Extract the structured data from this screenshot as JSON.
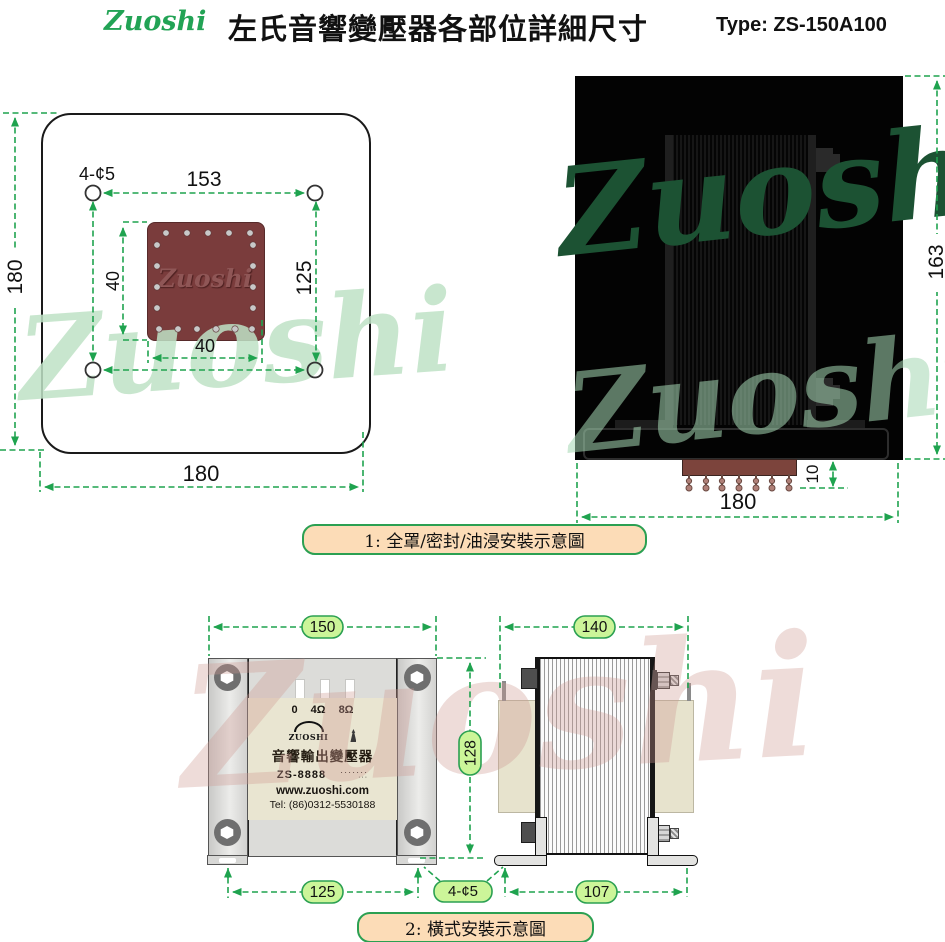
{
  "header": {
    "logo": "Zuoshi",
    "title": "左氏音響變壓器各部位詳細尺寸",
    "type_label": "Type: ZS-150A100"
  },
  "watermark": {
    "text": "Zuoshi"
  },
  "plate_view": {
    "hole_label": "4-¢5",
    "emboss": "Zuoshi",
    "dim_top_width": "153",
    "dim_left_height": "180",
    "dim_right_height": "125",
    "dim_square_height": "40",
    "dim_square_width": "40",
    "dim_bottom_width": "180"
  },
  "sealed_view": {
    "dim_height": "163",
    "dim_pin_height": "10",
    "dim_width": "180"
  },
  "caption1": "1: 全罩/密封/油浸安裝示意圖",
  "front_view": {
    "dim_width": "150",
    "dim_height": "128",
    "dim_hole_span": "125",
    "label": {
      "terminals": [
        "0",
        "4Ω",
        "8Ω"
      ],
      "brand": "ZUOSHI",
      "product": "音響輸出變壓器",
      "model": "ZS-8888",
      "dots": "·······",
      "dots2": "···",
      "website": "www.zuoshi.com",
      "tel": "Tel: (86)0312-5530188"
    }
  },
  "hole_note": "4-¢5",
  "side_view": {
    "dim_width": "140",
    "dim_hole_span": "107"
  },
  "caption2": "2: 橫式安裝示意圖"
}
